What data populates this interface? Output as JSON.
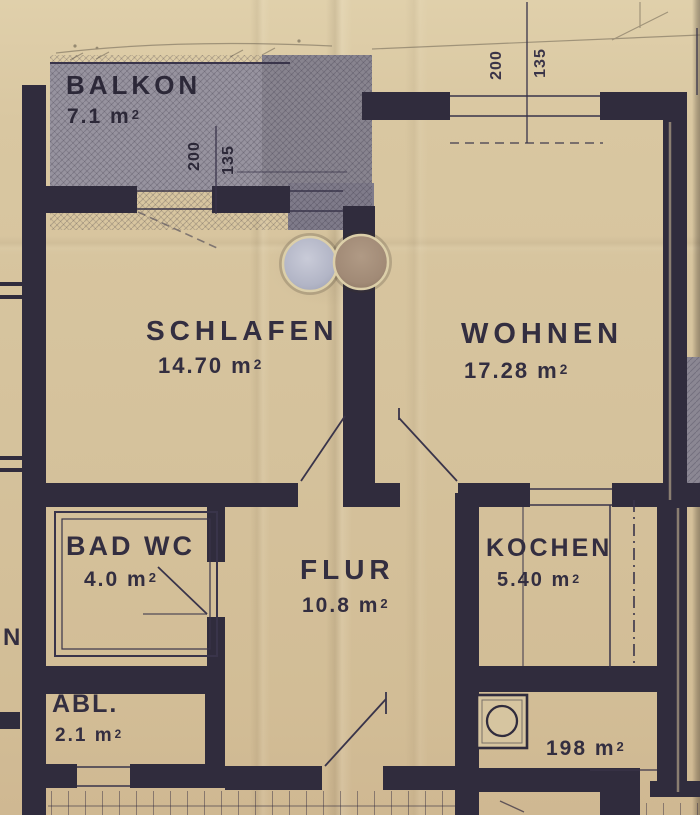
{
  "rooms": {
    "balkon": {
      "name": "BALKON",
      "area": "7.1 m²"
    },
    "schlafen": {
      "name": "SCHLAFEN",
      "area": "14.70 m²"
    },
    "wohnen": {
      "name": "WOHNEN",
      "area": "17.28 m²"
    },
    "bad": {
      "name": "BAD WC",
      "area": "4.0 m²"
    },
    "flur": {
      "name": "FLUR",
      "area": "10.8 m²"
    },
    "kochen": {
      "name": "KOCHEN",
      "area": "5.40 m²"
    },
    "abl": {
      "name": "ABL.",
      "area": "2.1 m²"
    }
  },
  "annotations": {
    "area_note": "198 m²",
    "neighbor_label_partial": "N"
  },
  "dimensions": {
    "living_window": [
      "200",
      "135"
    ],
    "balcony_window": [
      "200",
      "135"
    ]
  },
  "colors": {
    "paper": "#d5c29c",
    "ink": "#302c3d",
    "balcony_fill": "#97939f",
    "balcony_fill_dark": "#7f7b8a",
    "punch_hole_left": "#b9bcca",
    "punch_hole_right": "#a18a76"
  }
}
